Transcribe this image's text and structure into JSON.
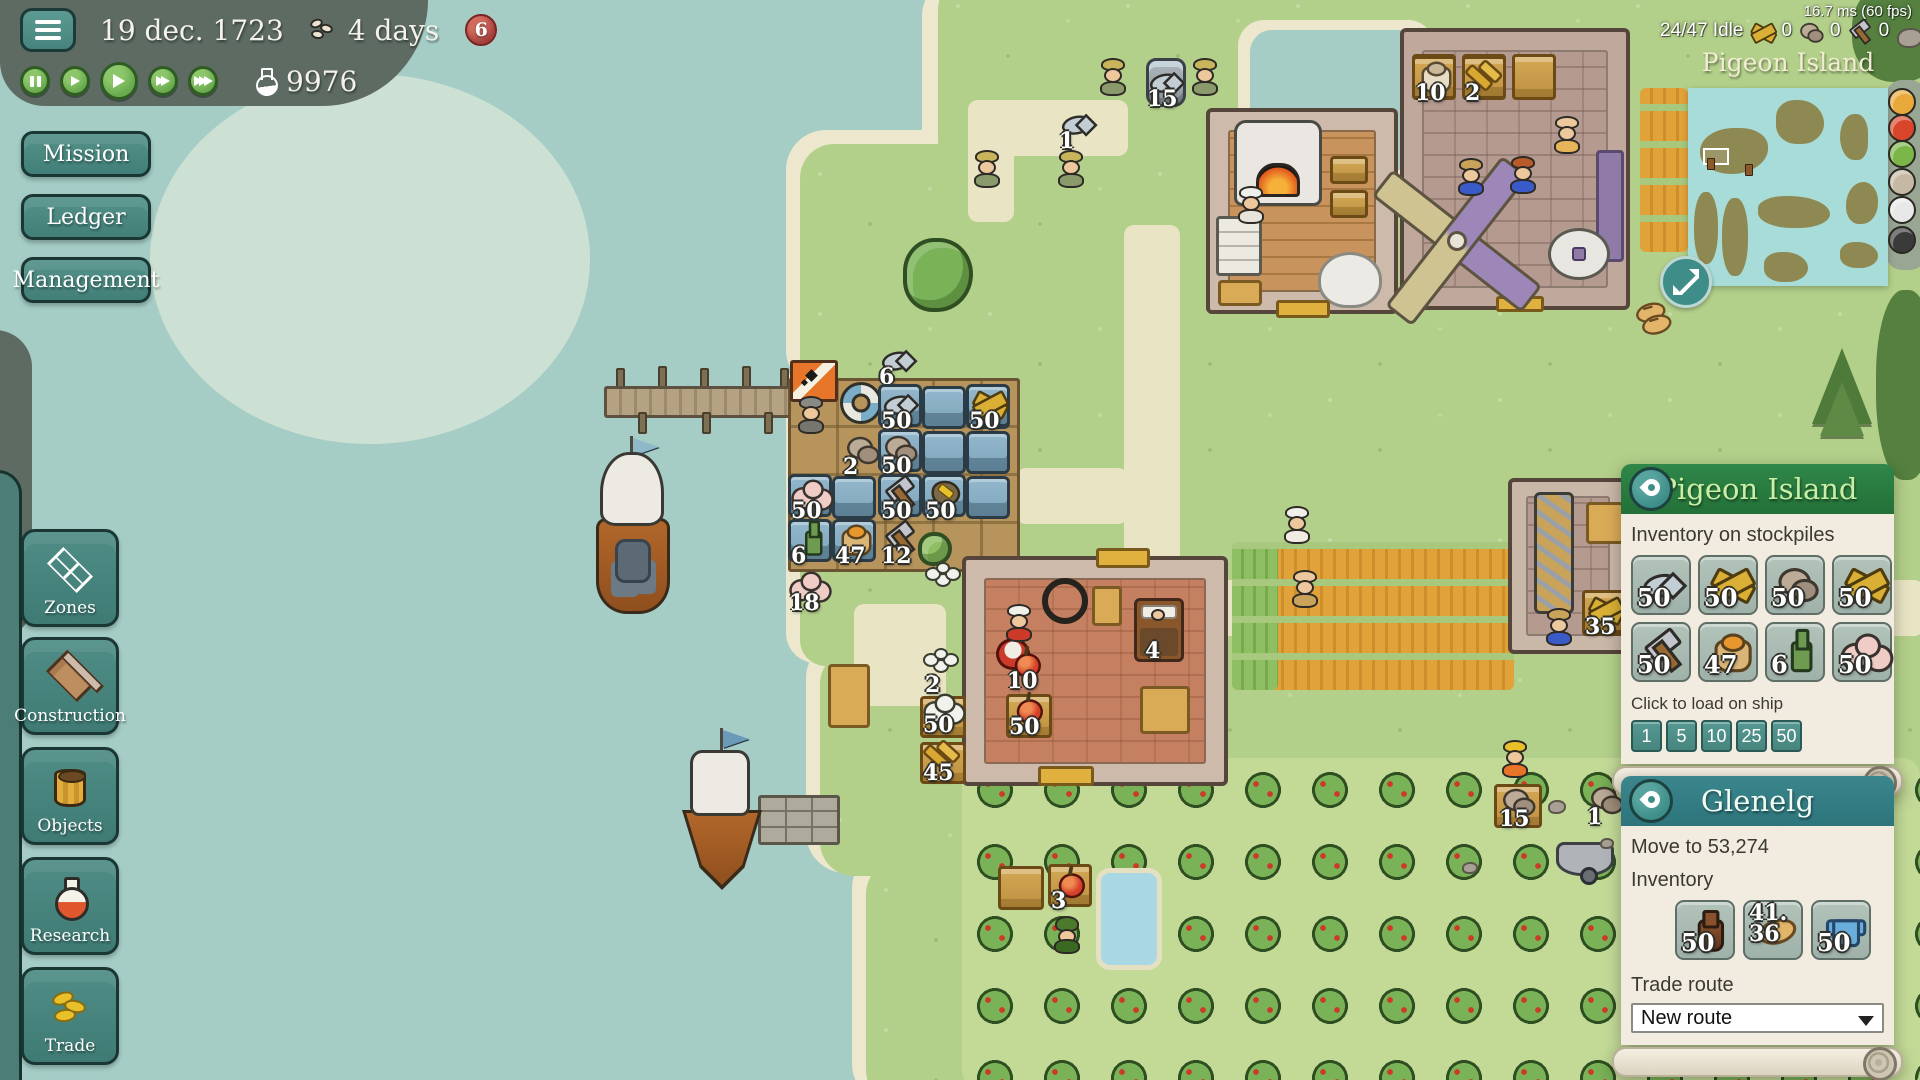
{
  "hud": {
    "date": "19 dec. 1723",
    "food_duration": "4 days",
    "notification_count": "6",
    "research_points": "9976",
    "performance": "16.7 ms (60 fps)",
    "workers_idle": "24/47 Idle",
    "resource_counters": [
      {
        "icon": "planks-icon",
        "count": "0"
      },
      {
        "icon": "stone-icon",
        "count": "0"
      },
      {
        "icon": "hammer-icon",
        "count": "0"
      }
    ],
    "playback_icons": [
      "pause",
      "play-slow",
      "play",
      "fast-forward",
      "fastest"
    ],
    "minimap": {
      "title": "Pigeon Island"
    }
  },
  "menu": {
    "mission": "Mission",
    "ledger": "Ledger",
    "management": "Management"
  },
  "toolbar": [
    {
      "icon": "zones-icon",
      "label": "Zones"
    },
    {
      "icon": "construction-icon",
      "label": "Construction"
    },
    {
      "icon": "objects-icon",
      "label": "Objects"
    },
    {
      "icon": "research-icon",
      "label": "Research"
    },
    {
      "icon": "trade-icon",
      "label": "Trade"
    }
  ],
  "island_panel": {
    "title": "Pigeon Island",
    "inventory_heading": "Inventory on stockpiles",
    "items": [
      {
        "icon": "fish-icon",
        "count": "50"
      },
      {
        "icon": "planks-icon",
        "count": "50"
      },
      {
        "icon": "stones-icon",
        "count": "50"
      },
      {
        "icon": "boards-icon",
        "count": "50"
      },
      {
        "icon": "hammer-icon",
        "count": "50"
      },
      {
        "icon": "grain-sack-icon",
        "count": "47"
      },
      {
        "icon": "bottle-icon",
        "count": "6"
      },
      {
        "icon": "wool-icon",
        "count": "50"
      }
    ],
    "load_heading": "Click to load on ship",
    "load_amounts": [
      "1",
      "5",
      "10",
      "25",
      "50"
    ]
  },
  "ship_panel": {
    "title": "Glenelg",
    "status": "Move to 53,274",
    "inventory_heading": "Inventory",
    "items": [
      {
        "icon": "jug-icon",
        "count": "50"
      },
      {
        "icon": "bread-icon",
        "count": "41.36"
      },
      {
        "icon": "shirt-icon",
        "count": "50"
      }
    ],
    "trade_route_heading": "Trade route",
    "trade_route_selected": "New route"
  },
  "map": {
    "markers": [
      {
        "icon": "fish-icon",
        "count": "6"
      },
      {
        "icon": "fish-icon",
        "count": "1"
      },
      {
        "icon": "fish-icon",
        "count": "15"
      },
      {
        "icon": "flour-icon",
        "count": "10"
      },
      {
        "icon": "wheat-icon",
        "count": "2"
      },
      {
        "icon": "stones-icon",
        "count": "2"
      },
      {
        "icon": "fish-icon",
        "count": "50"
      },
      {
        "icon": "planks-icon",
        "count": "50"
      },
      {
        "icon": "stones-icon",
        "count": "50"
      },
      {
        "icon": "wool-icon",
        "count": "50"
      },
      {
        "icon": "hammer-icon",
        "count": "50"
      },
      {
        "icon": "ore-icon",
        "count": "50"
      },
      {
        "icon": "bottle-icon",
        "count": "6"
      },
      {
        "icon": "grain-sack-icon",
        "count": "47"
      },
      {
        "icon": "hammer-icon",
        "count": "12"
      },
      {
        "icon": "wool-icon",
        "count": "18"
      },
      {
        "icon": "cotton-icon",
        "count": "2"
      },
      {
        "icon": "cotton-icon",
        "count": "50"
      },
      {
        "icon": "hay-icon",
        "count": "45"
      },
      {
        "icon": "apple-icon",
        "count": "10"
      },
      {
        "icon": "apple-icon",
        "count": "50"
      },
      {
        "icon": "bed-icon",
        "count": "4"
      },
      {
        "icon": "apple-icon",
        "count": "3"
      },
      {
        "icon": "stones-icon",
        "count": "15"
      },
      {
        "icon": "stones-icon",
        "count": "1"
      },
      {
        "icon": "planks-icon",
        "count": "35"
      }
    ]
  }
}
